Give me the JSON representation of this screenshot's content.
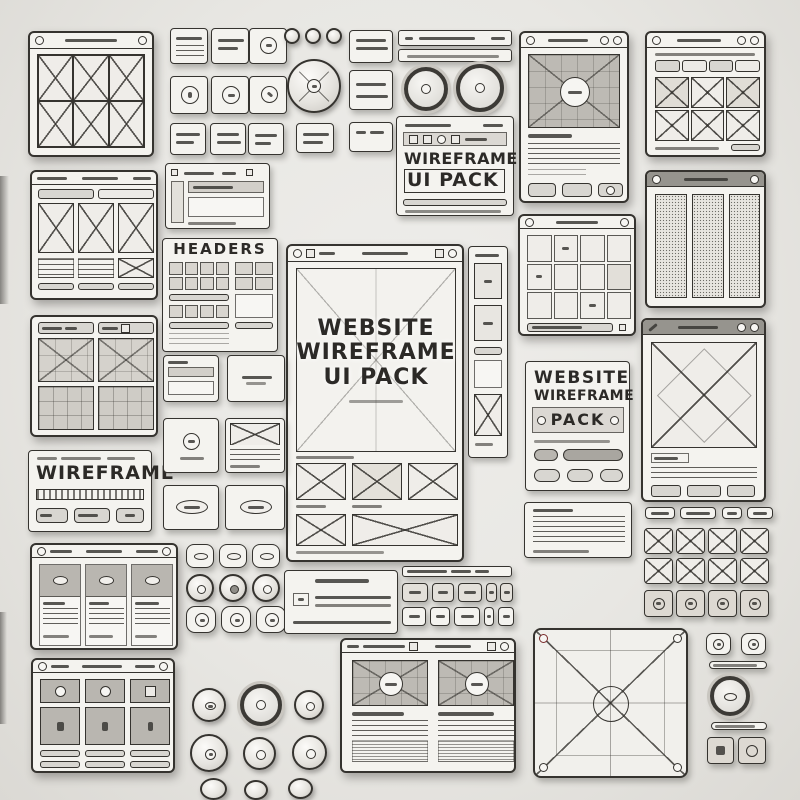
{
  "palette": {
    "background": "#e9e8e4",
    "paper": "#f4f3ef",
    "ink": "#35332f",
    "fill_gray": "#b9b6b0",
    "bar_dark": "#96948e",
    "button_gray": "#d8d6d1"
  },
  "center_window": {
    "title_lines": [
      "WEBSITE",
      "WIREFRAME",
      "UI PACK"
    ]
  },
  "top_pack_card": {
    "line1": "WIREFRAME",
    "line2": "UI PACK"
  },
  "headers_panel": {
    "title": "HEADERS"
  },
  "wireframe_card": {
    "title": "WIREFRAME"
  },
  "right_pack_card": {
    "line1": "WEBSITE",
    "line2": "WIREFRAME",
    "line3": "PACK"
  }
}
